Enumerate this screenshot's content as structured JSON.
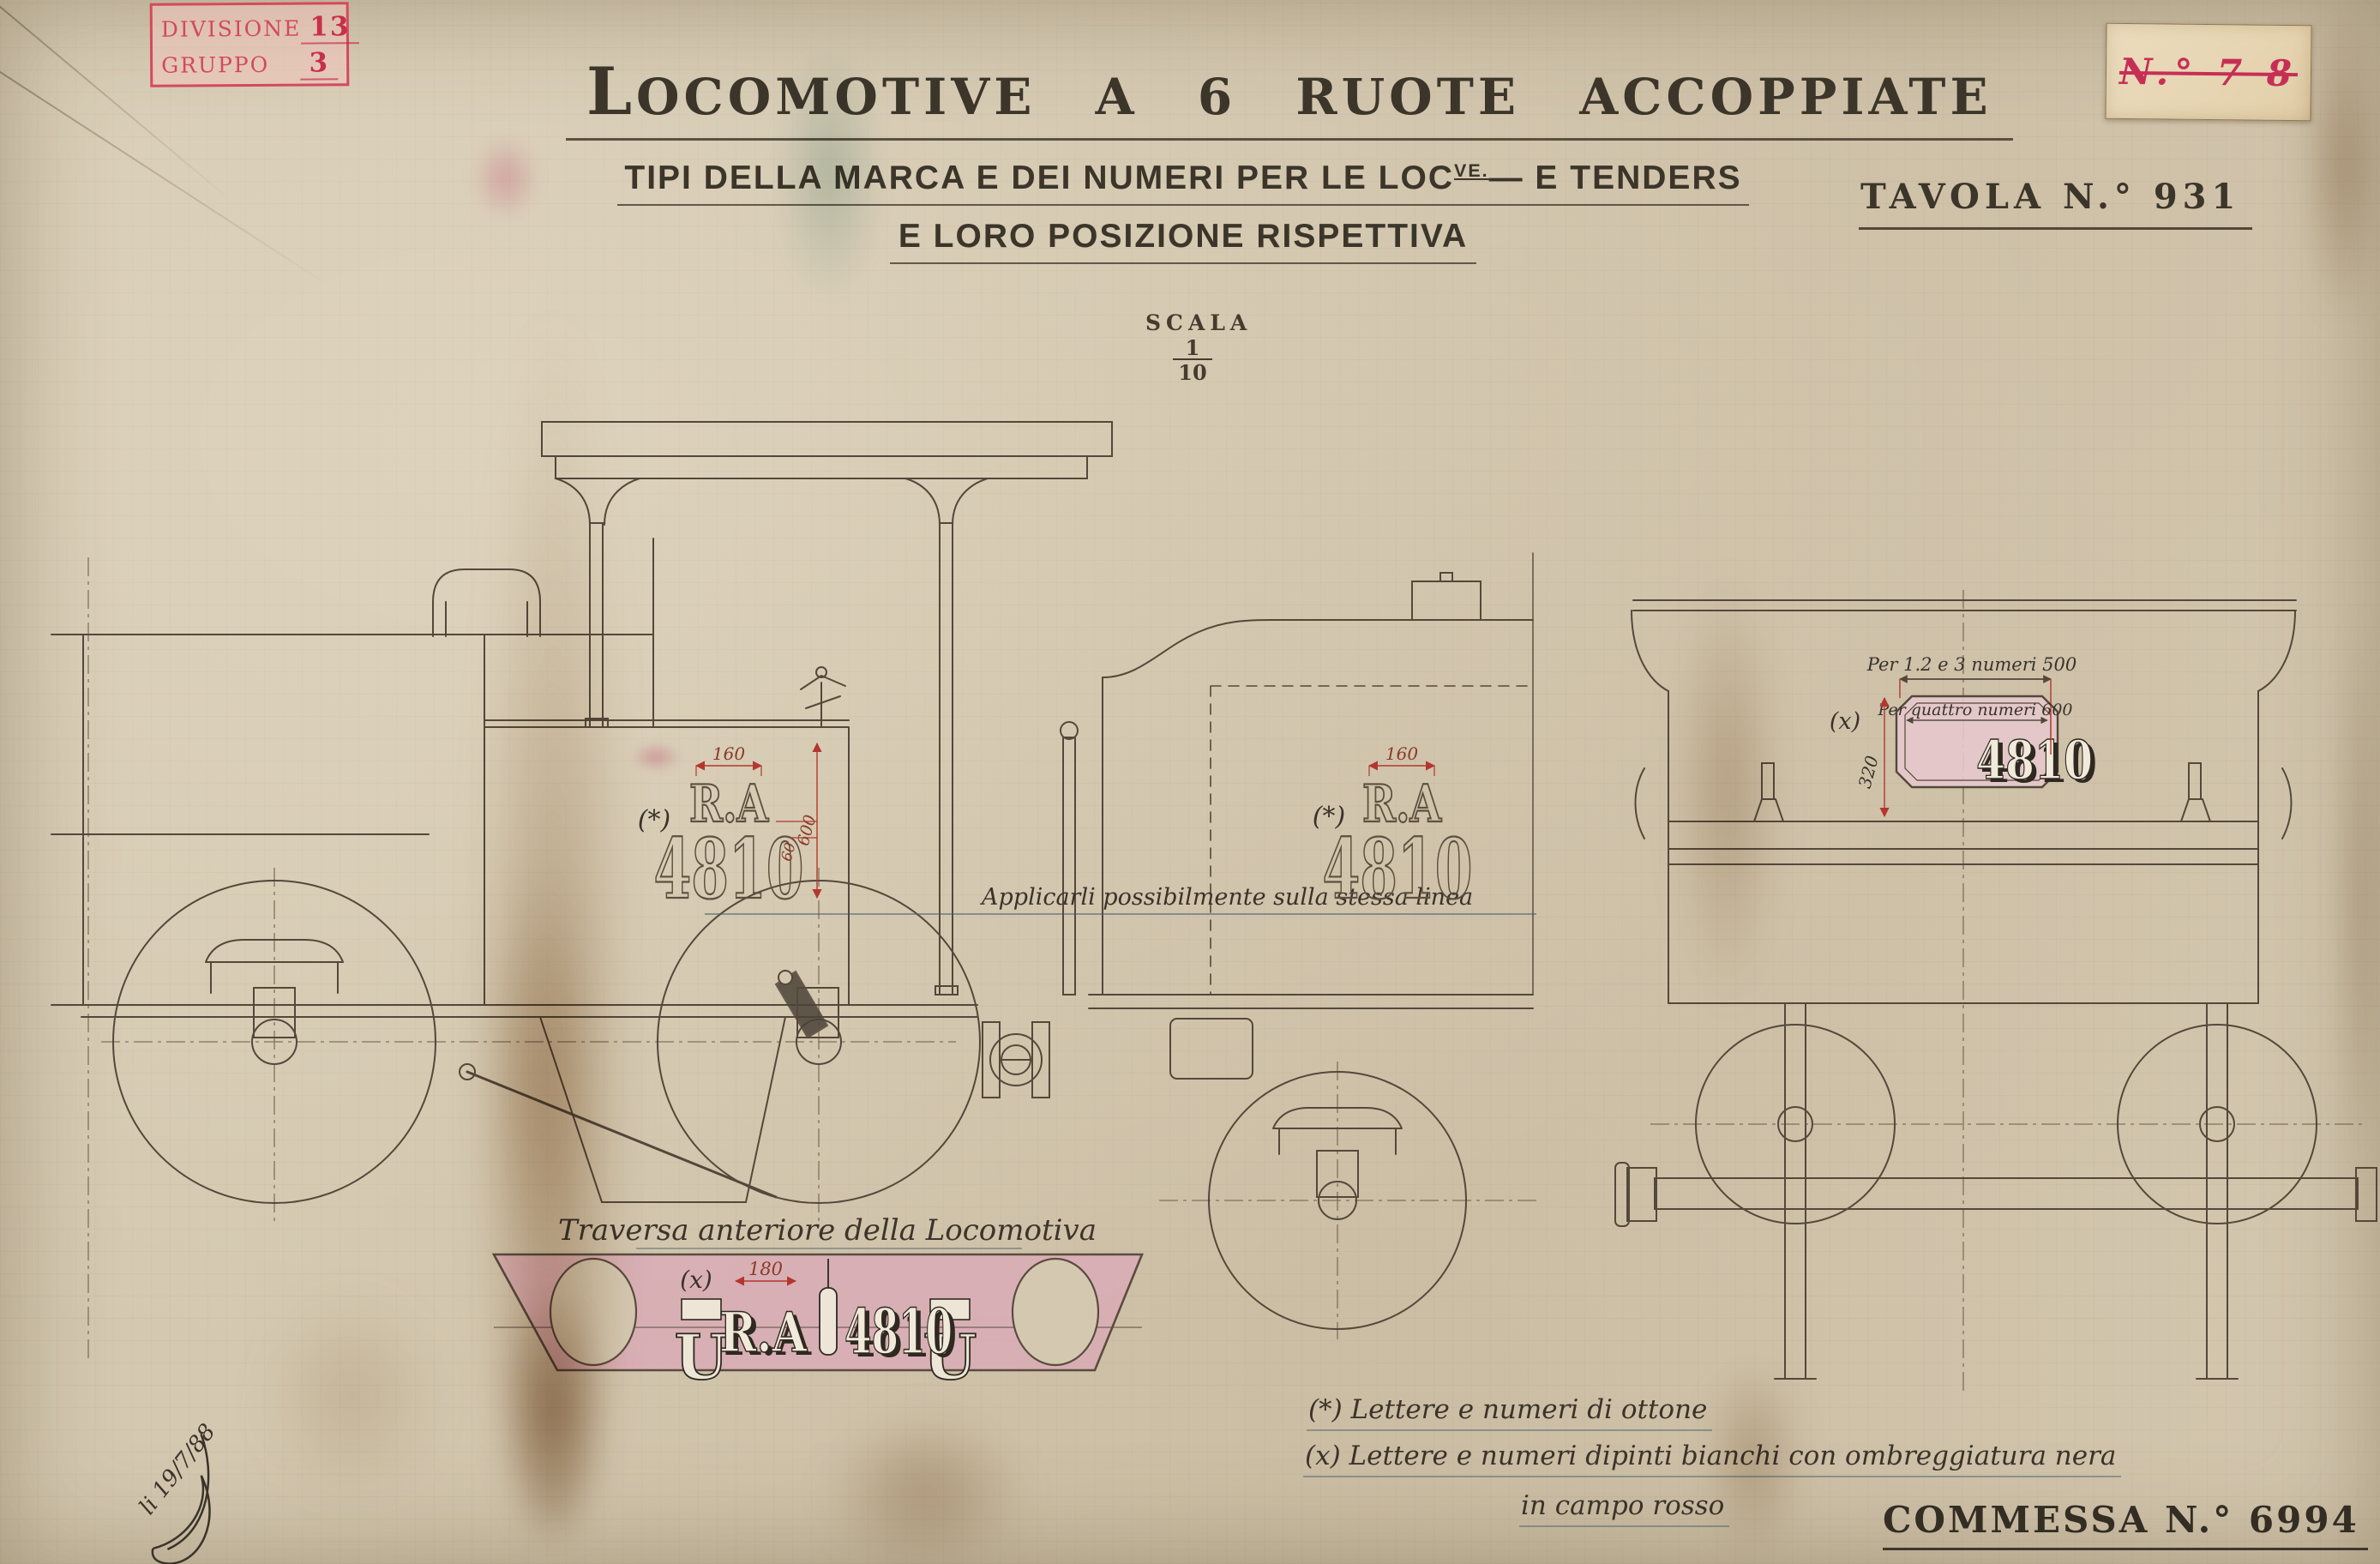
{
  "colors": {
    "ink": "#54483a",
    "dim_red": "#b3372e",
    "stamp_red": "#d4495d",
    "label_red": "#c62f55",
    "beam_pink": "#d9aab6",
    "plate_pink": "#e8c9cf",
    "paper": "#d4c8b0"
  },
  "stamp": {
    "row1_label": "DIVISIONE",
    "row1_value": "13",
    "row2_label": "GRUPPO",
    "row2_value": "3"
  },
  "doc_label": {
    "number": "N.° 7 8"
  },
  "header": {
    "title": "LOCOMOTIVE A 6 RUOTE ACCOPPIATE",
    "subtitle_pre": "TIPI DELLA MARCA E DEI NUMERI PER LE LOC",
    "subtitle_sup": "VE.",
    "subtitle_post": "— E TENDERS",
    "subtitle_line2": "E LORO POSIZIONE RISPETTIVA",
    "tavola": "TAVOLA N.° 931"
  },
  "scala": {
    "label": "SCALA",
    "numerator": "1",
    "denominator": "10"
  },
  "loco_marking": {
    "ref": "(*)",
    "letters": "R.A",
    "number": "4810",
    "dim_width": "160",
    "dim_gap": "60",
    "dim_height": "600"
  },
  "tender_marking": {
    "ref": "(*)",
    "letters": "R.A",
    "number": "4810",
    "dim_width": "160"
  },
  "alignment_note": "Applicarli possibilmente sulla stessa linea",
  "beam": {
    "caption": "Traversa anteriore della Locomotiva",
    "ref": "(x)",
    "dim_width": "180",
    "letters": "R.A",
    "number": "4810",
    "shackle_glyph": "U"
  },
  "plate": {
    "ref": "(x)",
    "dim_top": "Per 1.2 e 3 numeri 500",
    "dim_inner": "Per quattro numeri 600",
    "dim_height": "320",
    "number": "4810"
  },
  "legend": {
    "line1": "(*) Lettere e numeri di ottone",
    "line2": "(x) Lettere e numeri dipinti bianchi con ombreggiatura nera",
    "line3": "in campo rosso"
  },
  "signature": "li 19/7/88",
  "footer": {
    "commessa": "COMMESSA N.° 6994"
  }
}
